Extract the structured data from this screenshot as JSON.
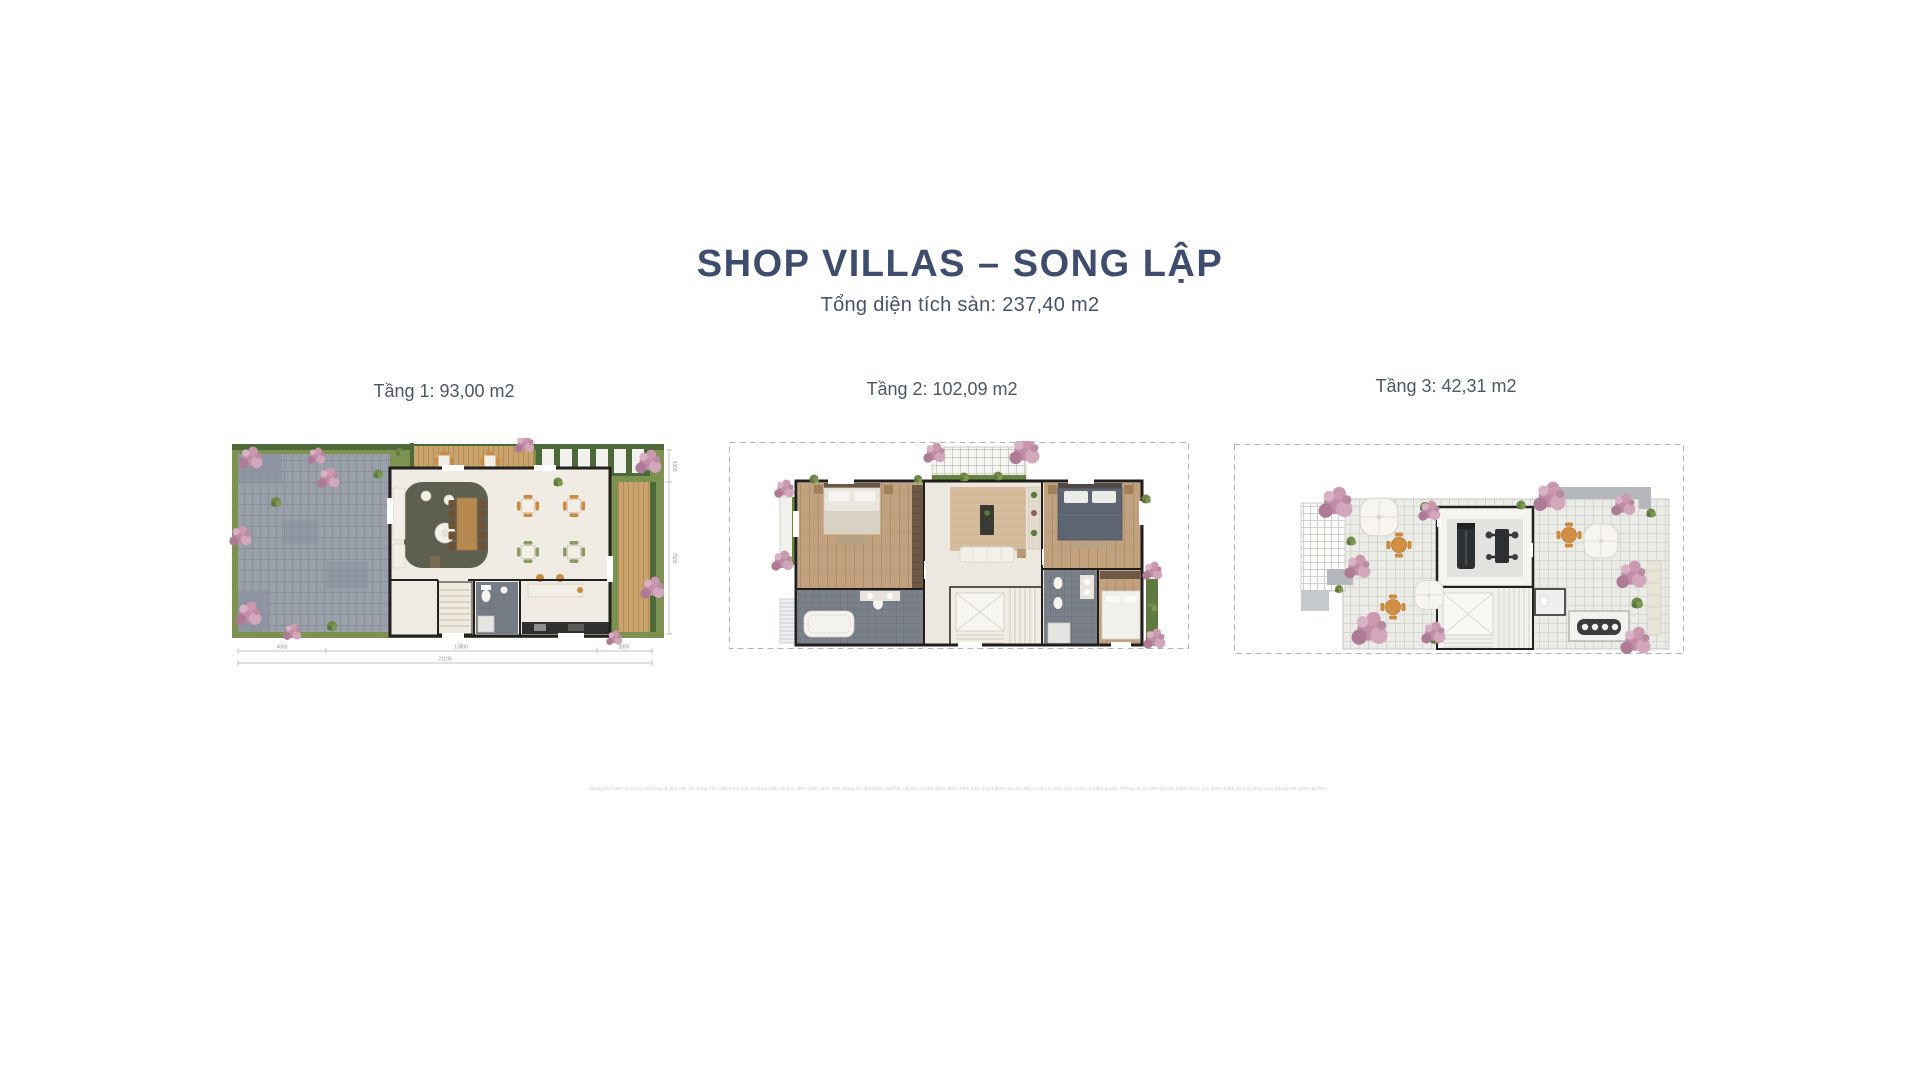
{
  "page": {
    "title": "SHOP VILLAS – SONG LẬP",
    "subtitle": "Tổng diện tích sàn: 237,40 m2",
    "disclaimer": "Những hình ảnh và thông tin trong tài liệu này chỉ mang tính chất minh họa và tham khảo tại thời điểm phát hành. Các thông số, diện tích, thiết kế, vật liệu có thể được điều chỉnh theo quyết định của chủ đầu tư và cơ quan nhà nước có thẩm quyền. Thông tin chi tiết của sản phẩm được quy định cụ thể tại hợp đồng mua bán ký kết giữa các bên.",
    "colors": {
      "accent_navy": "#3e4d6d",
      "label_gray": "#4c5666",
      "flower_pink": "#c490a7",
      "lawn_green": "#7d9150",
      "deck_wood": "#c9a36b",
      "wall_black": "#21211f"
    }
  },
  "plans": [
    {
      "label": "Tầng 1: 93,00 m2",
      "dims": {
        "segments": [
          "4500",
          "13800",
          "2800"
        ],
        "total": "21100",
        "right_upper": "3300",
        "right_lower": "7500"
      }
    },
    {
      "label": "Tầng 2: 102,09 m2"
    },
    {
      "label": "Tầng 3: 42,31 m2"
    }
  ]
}
